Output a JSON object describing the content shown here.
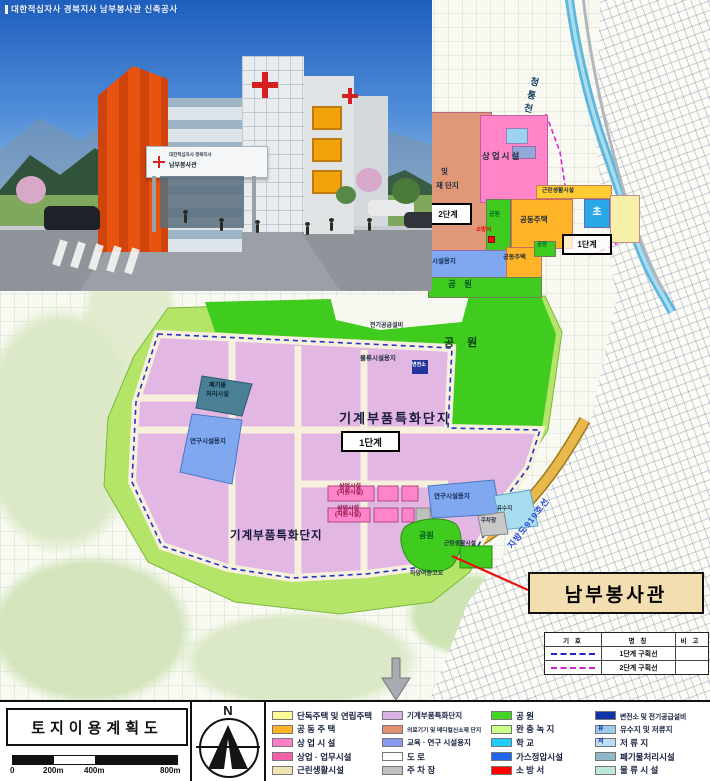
{
  "title_bar": "대한적십자사 경북지사 남부봉사관 신축공사",
  "rendering": {
    "canopy_line1": "대한적십자사 경북지사",
    "canopy_line2": "남부봉사관"
  },
  "upper_plan": {
    "commercial": "상업시설",
    "medical_partial_1": "및",
    "medical_partial_2": "재 단지",
    "neighborhood": "근린생활시설",
    "park1": "공원",
    "apartments1": "공동주택",
    "school_elem": "초",
    "fire_station": "소방서",
    "phase_left": "2단계",
    "phase_right": "1단계",
    "apartments2": "공동주택",
    "research": "연구시설용지",
    "park2": "공원",
    "park_band": "공 원"
  },
  "main_plan": {
    "power_supply": "전기공급설비",
    "park_top": "공  원",
    "logistics": "물류시설용지",
    "substation": "변전소",
    "waste_1": "폐기물",
    "waste_2": "처리시설",
    "complex_title": "기계부품특화단지",
    "phase1_box": "1단계",
    "research_left": "연구시설용지",
    "commercial1_line1": "상업시설",
    "commercial1_line2": "(지원시설)",
    "commercial2_line1": "상업시설",
    "commercial2_line2": "(지원시설)",
    "complex_title2": "기계부품특화단지",
    "research_right": "연구시설용지",
    "retention": "유수지",
    "parking": "주차장",
    "park_south": "공원",
    "neighborhood_south": "근린생활시설",
    "school": "하양여중고교",
    "road_919": "지방도919호선",
    "river": "청통천"
  },
  "callout": {
    "label": "남부봉사관"
  },
  "symbol_table": {
    "headers": [
      "기  호",
      "명  칭",
      "비  고"
    ],
    "rows": [
      {
        "name": "1단계 구획선",
        "color": "#2222cc"
      },
      {
        "name": "2단계 구획선",
        "color": "#cc22cc"
      }
    ]
  },
  "footer": {
    "title": "토지이용계획도",
    "north": "N",
    "scale_ticks": [
      "0",
      "200m",
      "400m",
      "800m"
    ],
    "legend": [
      {
        "label": "단독주택 및 연립주택",
        "color": "#ffff99"
      },
      {
        "label": "공 동 주 택",
        "color": "#ffb428"
      },
      {
        "label": "상 업 시 설",
        "color": "#ff7ec8"
      },
      {
        "label": "상업 · 업무시설",
        "color": "#f75fa8"
      },
      {
        "label": "근린생활시설",
        "color": "#f0e3b0"
      },
      {
        "label": "기계부품특화단지",
        "color": "#dcb3e6"
      },
      {
        "label": "의료기기 및 메디컬신소재 단지",
        "color": "#e09070"
      },
      {
        "label": "교육 · 연구 시설용지",
        "color": "#8899ee"
      },
      {
        "label": "도          로",
        "color": "#ffffff"
      },
      {
        "label": "주  차  장",
        "color": "#c0c0c0"
      },
      {
        "label": "공          원",
        "color": "#44d522"
      },
      {
        "label": "완 충 녹 지",
        "color": "#ccff88"
      },
      {
        "label": "학          교",
        "color": "#22ccff"
      },
      {
        "label": "가스정압시설",
        "color": "#2266ee"
      },
      {
        "label": "소  방  서",
        "color": "#ff0000"
      },
      {
        "label": "변전소 및 전기공급설비",
        "color": "#1133aa"
      },
      {
        "label": "유수지 및 저류지",
        "color": "#99ccee",
        "mark": "유"
      },
      {
        "label": "저  류  지",
        "color": "#bbddf5",
        "mark": "저"
      },
      {
        "label": "폐기물처리시설",
        "color": "#8fb8c8"
      },
      {
        "label": "물 류 시 설",
        "color": "#bbe8d8"
      }
    ]
  }
}
